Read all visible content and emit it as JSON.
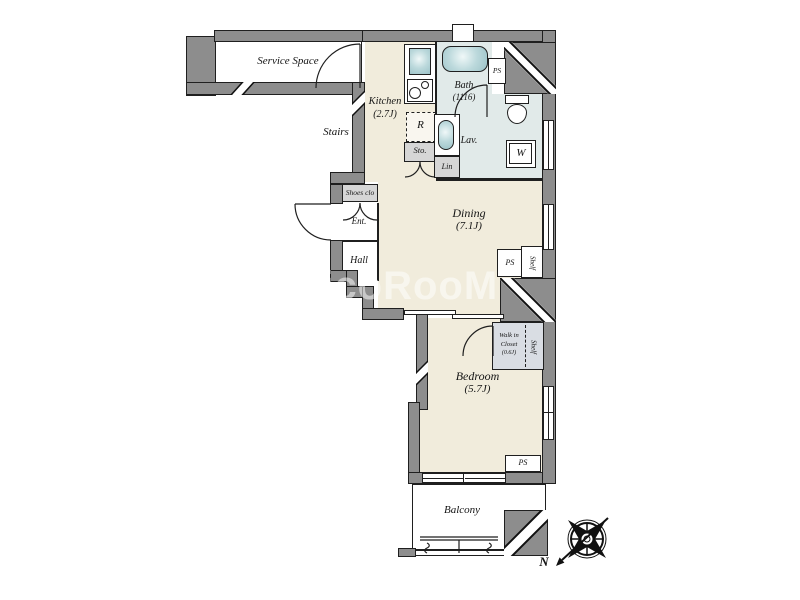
{
  "plan": {
    "type": "apartment-floor-plan",
    "watermark": "MicoRooM",
    "compass": {
      "label": "N"
    },
    "rooms": {
      "service_space": {
        "label": "Service Space"
      },
      "stairs": {
        "label": "Stairs"
      },
      "kitchen": {
        "label": "Kitchen",
        "size": "(2.7J)"
      },
      "bath": {
        "label": "Bath",
        "size": "(1116)"
      },
      "lav": {
        "label": "Lav."
      },
      "dining": {
        "label": "Dining",
        "size": "(7.1J)"
      },
      "bedroom": {
        "label": "Bedroom",
        "size": "(5.7J)"
      },
      "walk_in_closet": {
        "line1": "Walk in",
        "line2": "Closet",
        "size": "(0.6J)"
      },
      "hall": {
        "label": "Hall"
      },
      "entrance": {
        "label": "Ent."
      },
      "balcony": {
        "label": "Balcony"
      }
    },
    "fixtures": {
      "shoes_closet": "Shoes clo",
      "refrigerator": "R",
      "storage": "Sto.",
      "linen": "Lin",
      "washer": "W",
      "ps_top": "PS",
      "ps_mid": "PS",
      "ps_bottom": "PS",
      "shelf_mid": "Shelf",
      "shelf_closet": "Shelf"
    },
    "colors": {
      "wall": "#8d8d8d",
      "outline": "#1f1f1f",
      "floor": "#f1ecdc",
      "wet_area": "#e1eae9",
      "fixture": "#9cc3c8",
      "box": "#d6d6d6"
    }
  }
}
